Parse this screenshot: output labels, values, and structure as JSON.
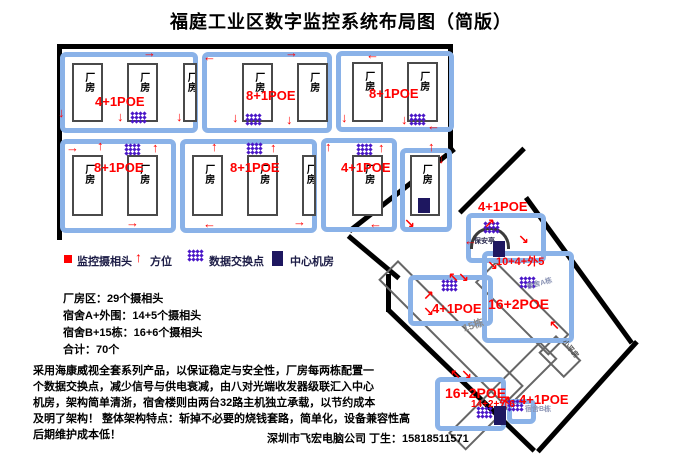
{
  "title": "福庭工业区数字监控系统布局图（简版）",
  "legend": {
    "items": [
      {
        "label": "监控摄相头"
      },
      {
        "label": "方位"
      },
      {
        "label": "数据交换点"
      },
      {
        "label": "中心机房"
      }
    ]
  },
  "stats": [
    "厂房区：29个摄相头",
    "宿舍A+外围：14+5个摄相头",
    "宿舍B+15栋：16+6个摄相头",
    "合计：70个"
  ],
  "description": [
    "采用海康威视全套系列产品，以保证稳定与安全性，厂房每两栋配置一",
    "个数据交换点，减少信号与供电衰减，由八对光端收发器级联汇入中心",
    "机房，架构简单清浙，宿舍楼则由两台32路主机独立承载，以节约成本",
    "及明了架构！ 整体架构特点：斩掉不必要的烧钱套路，简单化，设备兼容性高",
    "后期维护成本低！"
  ],
  "footer": "深圳市飞宏电脑公司 丁生：15818511571",
  "colors": {
    "block_border": "#8ab2e8",
    "label_red": "#ff0000",
    "switch_purple": "#4b18c8",
    "server_navy": "#1e1760"
  },
  "diagram": {
    "building_label": "厂房",
    "elements": [
      {
        "t": "boundary",
        "n": "factory-wall-top",
        "x": 57,
        "y": 44,
        "w": 396,
        "h": 5
      },
      {
        "t": "boundary",
        "n": "factory-wall-left",
        "x": 57,
        "y": 44,
        "w": 5,
        "h": 196
      },
      {
        "t": "boundary",
        "n": "factory-wall-right",
        "x": 448,
        "y": 44,
        "w": 5,
        "h": 108
      },
      {
        "t": "boundary",
        "n": "factory-wall-diagonal",
        "x": 348,
        "y": 229,
        "w": 133,
        "h": 5,
        "rot": -38
      },
      {
        "t": "boundary",
        "n": "road-curve",
        "x": 350,
        "y": 234,
        "w": 66,
        "h": 5,
        "rot": 40
      },
      {
        "t": "boundary",
        "n": "road-connector",
        "x": 386,
        "y": 274,
        "w": 5,
        "h": 38
      },
      {
        "t": "boundary",
        "n": "site-edge-entrance",
        "x": 458,
        "y": 211,
        "w": 91,
        "h": 5,
        "rot": -45
      },
      {
        "t": "boundary",
        "n": "site-edge-northeast",
        "x": 528,
        "y": 196,
        "w": 180,
        "h": 5,
        "rot": 54
      },
      {
        "t": "boundary",
        "n": "site-edge-southwest",
        "x": 390,
        "y": 308,
        "w": 203,
        "h": 5,
        "rot": 44
      },
      {
        "t": "boundary",
        "n": "site-edge-southeast",
        "x": 536,
        "y": 450,
        "w": 148,
        "h": 5,
        "rot": -48
      },
      {
        "t": "thin",
        "n": "building-15dong",
        "x": 398,
        "y": 260,
        "w": 178,
        "h": 28,
        "rot": 45
      },
      {
        "t": "thin",
        "n": "building-dorm-a",
        "x": 496,
        "y": 261,
        "w": 104,
        "h": 30,
        "rot": 45
      },
      {
        "t": "thin",
        "n": "building-xiaopingfang",
        "x": 556,
        "y": 335,
        "w": 36,
        "h": 25,
        "rot": 45
      },
      {
        "t": "thin",
        "n": "building-dorm-b",
        "x": 448,
        "y": 433,
        "w": 130,
        "h": 25,
        "rot": -45
      },
      {
        "t": "block",
        "n": "factory-block-1",
        "x": 60,
        "y": 52,
        "w": 138,
        "h": 81
      },
      {
        "t": "block",
        "n": "factory-block-2",
        "x": 202,
        "y": 52,
        "w": 130,
        "h": 81
      },
      {
        "t": "block",
        "n": "factory-block-3",
        "x": 336,
        "y": 51,
        "w": 118,
        "h": 81
      },
      {
        "t": "block",
        "n": "factory-block-4",
        "x": 60,
        "y": 139,
        "w": 116,
        "h": 94
      },
      {
        "t": "block",
        "n": "factory-block-5",
        "x": 180,
        "y": 139,
        "w": 137,
        "h": 94
      },
      {
        "t": "block",
        "n": "factory-block-6",
        "x": 321,
        "y": 138,
        "w": 76,
        "h": 94
      },
      {
        "t": "block",
        "n": "factory-block-server",
        "x": 400,
        "y": 148,
        "w": 52,
        "h": 84
      },
      {
        "t": "block",
        "n": "gate-block",
        "x": 466,
        "y": 213,
        "w": 80,
        "h": 50
      },
      {
        "t": "block",
        "n": "dorm-a-block",
        "x": 482,
        "y": 251,
        "w": 92,
        "h": 92
      },
      {
        "t": "block",
        "n": "15dong-block",
        "x": 408,
        "y": 275,
        "w": 85,
        "h": 51
      },
      {
        "t": "block",
        "n": "dorm-b-block",
        "x": 435,
        "y": 377,
        "w": 71,
        "h": 54
      },
      {
        "t": "block",
        "n": "dorm-b-switch-block",
        "x": 507,
        "y": 399,
        "w": 29,
        "h": 25
      },
      {
        "t": "building",
        "x": 72,
        "y": 63,
        "w": 31,
        "h": 59
      },
      {
        "t": "building",
        "x": 127,
        "y": 63,
        "w": 31,
        "h": 59
      },
      {
        "t": "building",
        "x": 183,
        "y": 63,
        "w": 14,
        "h": 59
      },
      {
        "t": "building",
        "x": 242,
        "y": 63,
        "w": 31,
        "h": 59
      },
      {
        "t": "building",
        "x": 297,
        "y": 63,
        "w": 31,
        "h": 59
      },
      {
        "t": "building",
        "x": 352,
        "y": 62,
        "w": 31,
        "h": 60
      },
      {
        "t": "building",
        "x": 407,
        "y": 62,
        "w": 31,
        "h": 60
      },
      {
        "t": "building",
        "x": 72,
        "y": 155,
        "w": 31,
        "h": 61
      },
      {
        "t": "building",
        "x": 127,
        "y": 155,
        "w": 31,
        "h": 61
      },
      {
        "t": "building",
        "x": 192,
        "y": 155,
        "w": 31,
        "h": 61
      },
      {
        "t": "building",
        "x": 247,
        "y": 155,
        "w": 31,
        "h": 61
      },
      {
        "t": "building",
        "x": 302,
        "y": 155,
        "w": 14,
        "h": 61
      },
      {
        "t": "building",
        "x": 352,
        "y": 155,
        "w": 31,
        "h": 61
      },
      {
        "t": "building",
        "x": 410,
        "y": 155,
        "w": 30,
        "h": 61
      },
      {
        "t": "label",
        "n": "poe-label",
        "x": 95,
        "y": 95,
        "text": "4+1POE",
        "fs": 13
      },
      {
        "t": "label",
        "n": "poe-label",
        "x": 246,
        "y": 89,
        "text": "8+1POE",
        "fs": 13
      },
      {
        "t": "label",
        "n": "poe-label",
        "x": 369,
        "y": 87,
        "text": "8+1POE",
        "fs": 13
      },
      {
        "t": "label",
        "n": "poe-label",
        "x": 94,
        "y": 161,
        "text": "8+1POE",
        "fs": 13
      },
      {
        "t": "label",
        "n": "poe-label",
        "x": 230,
        "y": 161,
        "text": "8+1POE",
        "fs": 13
      },
      {
        "t": "label",
        "n": "poe-label",
        "x": 341,
        "y": 161,
        "text": "4+1POE",
        "fs": 13
      },
      {
        "t": "label",
        "n": "poe-label",
        "x": 478,
        "y": 200,
        "text": "4+1POE",
        "fs": 13
      },
      {
        "t": "label",
        "n": "count-label",
        "x": 496,
        "y": 257,
        "text": "10+4+外5",
        "fs": 11
      },
      {
        "t": "label",
        "n": "poe-label",
        "x": 488,
        "y": 297,
        "text": "16+2POE",
        "fs": 14
      },
      {
        "t": "label",
        "n": "poe-label",
        "x": 432,
        "y": 302,
        "text": "4+1POE",
        "fs": 13
      },
      {
        "t": "label",
        "n": "poe-label",
        "x": 445,
        "y": 386,
        "text": "16+2POE",
        "fs": 14
      },
      {
        "t": "label",
        "n": "count-label",
        "x": 471,
        "y": 400,
        "text": "14+2+外6",
        "fs": 10
      },
      {
        "t": "label",
        "n": "poe-label",
        "x": 519,
        "y": 393,
        "text": "4+1POE",
        "fs": 13
      },
      {
        "t": "dots",
        "n": "switch-icon",
        "x": 131,
        "y": 112
      },
      {
        "t": "dots",
        "n": "switch-icon",
        "x": 246,
        "y": 114
      },
      {
        "t": "dots",
        "n": "switch-icon",
        "x": 410,
        "y": 114
      },
      {
        "t": "dots",
        "n": "switch-icon",
        "x": 125,
        "y": 144
      },
      {
        "t": "dots",
        "n": "switch-icon",
        "x": 247,
        "y": 143
      },
      {
        "t": "dots",
        "n": "switch-icon",
        "x": 357,
        "y": 144
      },
      {
        "t": "dots",
        "n": "switch-icon",
        "x": 484,
        "y": 222
      },
      {
        "t": "dots",
        "n": "switch-icon",
        "x": 520,
        "y": 277
      },
      {
        "t": "dots",
        "n": "switch-icon",
        "x": 442,
        "y": 280
      },
      {
        "t": "dots",
        "n": "switch-icon",
        "x": 477,
        "y": 407
      },
      {
        "t": "dots",
        "n": "switch-icon",
        "x": 508,
        "y": 400
      },
      {
        "t": "dots",
        "n": "legend-switch-icon",
        "x": 188,
        "y": 250
      },
      {
        "t": "server",
        "n": "central-server-room",
        "x": 418,
        "y": 198,
        "w": 12,
        "h": 15
      },
      {
        "t": "server",
        "n": "gate-server",
        "x": 493,
        "y": 241,
        "w": 12,
        "h": 16
      },
      {
        "t": "server",
        "n": "dorm-b-server",
        "x": 494,
        "y": 406,
        "w": 12,
        "h": 19
      },
      {
        "t": "server",
        "n": "legend-server-icon",
        "x": 272,
        "y": 251,
        "w": 11,
        "h": 15
      },
      {
        "t": "redsq",
        "n": "legend-camera-icon",
        "x": 64,
        "y": 255,
        "w": 8,
        "h": 8
      },
      {
        "t": "arrow",
        "n": "legend-direction-icon",
        "x": 135,
        "y": 250,
        "text": "↑",
        "fs": 14
      },
      {
        "t": "dome",
        "n": "security-booth",
        "x": 470,
        "y": 227,
        "w": 40,
        "h": 22
      },
      {
        "t": "txt",
        "n": "label-15dong",
        "x": 462,
        "y": 325,
        "text": "15栋",
        "c": "#8a8a8a",
        "fs": 10,
        "rot": -18
      },
      {
        "t": "txt",
        "n": "label-dorm-a",
        "x": 526,
        "y": 284,
        "text": "宿舍A栋",
        "c": "#8a93b4",
        "fs": 7,
        "rot": -15
      },
      {
        "t": "txt",
        "n": "label-dorm-b",
        "x": 525,
        "y": 406,
        "text": "宿舍B栋",
        "c": "#8a93b4",
        "fs": 7
      },
      {
        "t": "txt",
        "n": "label-security",
        "x": 474,
        "y": 238,
        "text": "保安亭",
        "c": "#26264a",
        "fs": 7
      },
      {
        "t": "txt",
        "n": "label-xiaopingfang",
        "x": 566,
        "y": 339,
        "text": "小平房",
        "c": "#555",
        "fs": 7,
        "rot": 50
      },
      {
        "t": "arrow",
        "x": 143,
        "y": 46,
        "text": "→"
      },
      {
        "t": "arrow",
        "x": 58,
        "y": 106,
        "text": "↓"
      },
      {
        "t": "arrow",
        "x": 117,
        "y": 110,
        "text": "↓"
      },
      {
        "t": "arrow",
        "x": 176,
        "y": 110,
        "text": "↓"
      },
      {
        "t": "arrow",
        "x": 203,
        "y": 50,
        "text": "←"
      },
      {
        "t": "arrow",
        "x": 285,
        "y": 46,
        "text": "→"
      },
      {
        "t": "arrow",
        "x": 232,
        "y": 111,
        "text": "↓"
      },
      {
        "t": "arrow",
        "x": 286,
        "y": 113,
        "text": "↓"
      },
      {
        "t": "arrow",
        "x": 366,
        "y": 48,
        "text": "←"
      },
      {
        "t": "arrow",
        "x": 341,
        "y": 111,
        "text": "↓"
      },
      {
        "t": "arrow",
        "x": 401,
        "y": 113,
        "text": "↓"
      },
      {
        "t": "arrow",
        "x": 427,
        "y": 119,
        "text": "←"
      },
      {
        "t": "arrow",
        "x": 66,
        "y": 141,
        "text": "→"
      },
      {
        "t": "arrow",
        "x": 97,
        "y": 139,
        "text": "↑"
      },
      {
        "t": "arrow",
        "x": 152,
        "y": 141,
        "text": "↑"
      },
      {
        "t": "arrow",
        "x": 126,
        "y": 216,
        "text": "→"
      },
      {
        "t": "arrow",
        "x": 211,
        "y": 140,
        "text": "↑"
      },
      {
        "t": "arrow",
        "x": 270,
        "y": 141,
        "text": "↑"
      },
      {
        "t": "arrow",
        "x": 203,
        "y": 217,
        "text": "←"
      },
      {
        "t": "arrow",
        "x": 293,
        "y": 215,
        "text": "→"
      },
      {
        "t": "arrow",
        "x": 325,
        "y": 140,
        "text": "↑"
      },
      {
        "t": "arrow",
        "x": 378,
        "y": 141,
        "text": "↑"
      },
      {
        "t": "arrow",
        "x": 369,
        "y": 217,
        "text": "←"
      },
      {
        "t": "arrow",
        "x": 428,
        "y": 140,
        "text": "↑"
      },
      {
        "t": "arrow",
        "x": 438,
        "y": 152,
        "text": "↓"
      },
      {
        "t": "arrow",
        "x": 404,
        "y": 217,
        "text": "↘"
      },
      {
        "t": "arrow",
        "x": 464,
        "y": 234,
        "text": "←"
      },
      {
        "t": "arrow",
        "x": 518,
        "y": 233,
        "text": "↘"
      },
      {
        "t": "arrow",
        "x": 484,
        "y": 217,
        "text": "↗"
      },
      {
        "t": "arrow",
        "x": 487,
        "y": 259,
        "text": "↘"
      },
      {
        "t": "arrow",
        "x": 549,
        "y": 319,
        "text": "↖"
      },
      {
        "t": "arrow",
        "x": 448,
        "y": 271,
        "text": "↖"
      },
      {
        "t": "arrow",
        "x": 458,
        "y": 271,
        "text": "↘"
      },
      {
        "t": "arrow",
        "x": 423,
        "y": 289,
        "text": "↗"
      },
      {
        "t": "arrow",
        "x": 423,
        "y": 305,
        "text": "↘"
      },
      {
        "t": "arrow",
        "x": 450,
        "y": 368,
        "text": "↖"
      },
      {
        "t": "arrow",
        "x": 461,
        "y": 368,
        "text": "↘"
      },
      {
        "t": "arrow",
        "x": 500,
        "y": 394,
        "text": "↗"
      }
    ]
  }
}
